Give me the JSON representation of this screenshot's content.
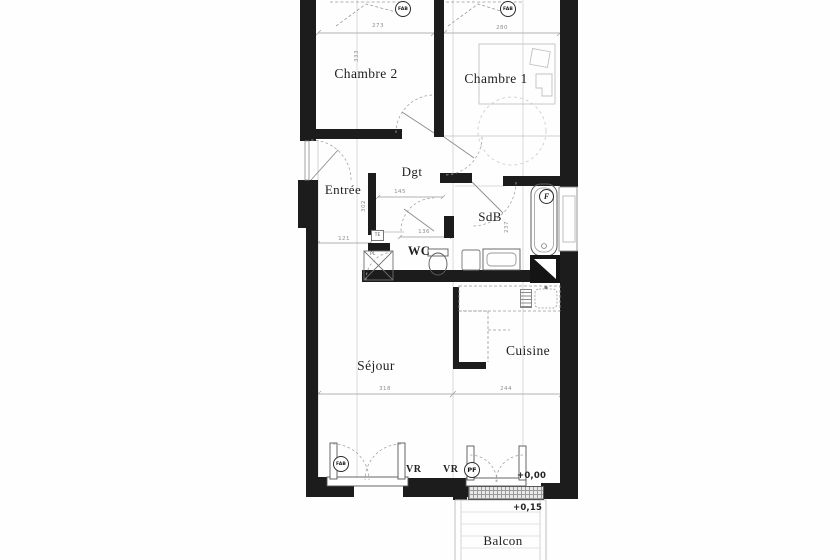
{
  "plan_title": "Appartement 2 chambres — plan d'étage",
  "rooms": {
    "chambre2": "Chambre 2",
    "chambre1": "Chambre 1",
    "entree": "Entrée",
    "dgt": "Dgt",
    "sdb": "SdB",
    "wc": "WC",
    "sejour": "Séjour",
    "cuisine": "Cuisine",
    "balcon": "Balcon"
  },
  "markers": {
    "fab": "FAB",
    "pf": "PF",
    "f": "F",
    "vr": "VR",
    "te": "TE",
    "pl": "PL"
  },
  "levels": {
    "main_floor": "+0,00",
    "balcony": "+0,15"
  },
  "dimensions": {
    "chambre2_width": "273",
    "chambre1_width": "280",
    "chambre2_height": "333",
    "dgt_width": "145",
    "wc_width": "136",
    "entree_width": "121",
    "entree_height": "302",
    "sdb_height": "237",
    "sejour_width": "318",
    "cuisine_width": "244"
  },
  "colors": {
    "wall": "#1c1c1c",
    "thin_line": "#b5b5b5",
    "dashed_line": "#a0a0a0",
    "paper": "#fefefe"
  }
}
